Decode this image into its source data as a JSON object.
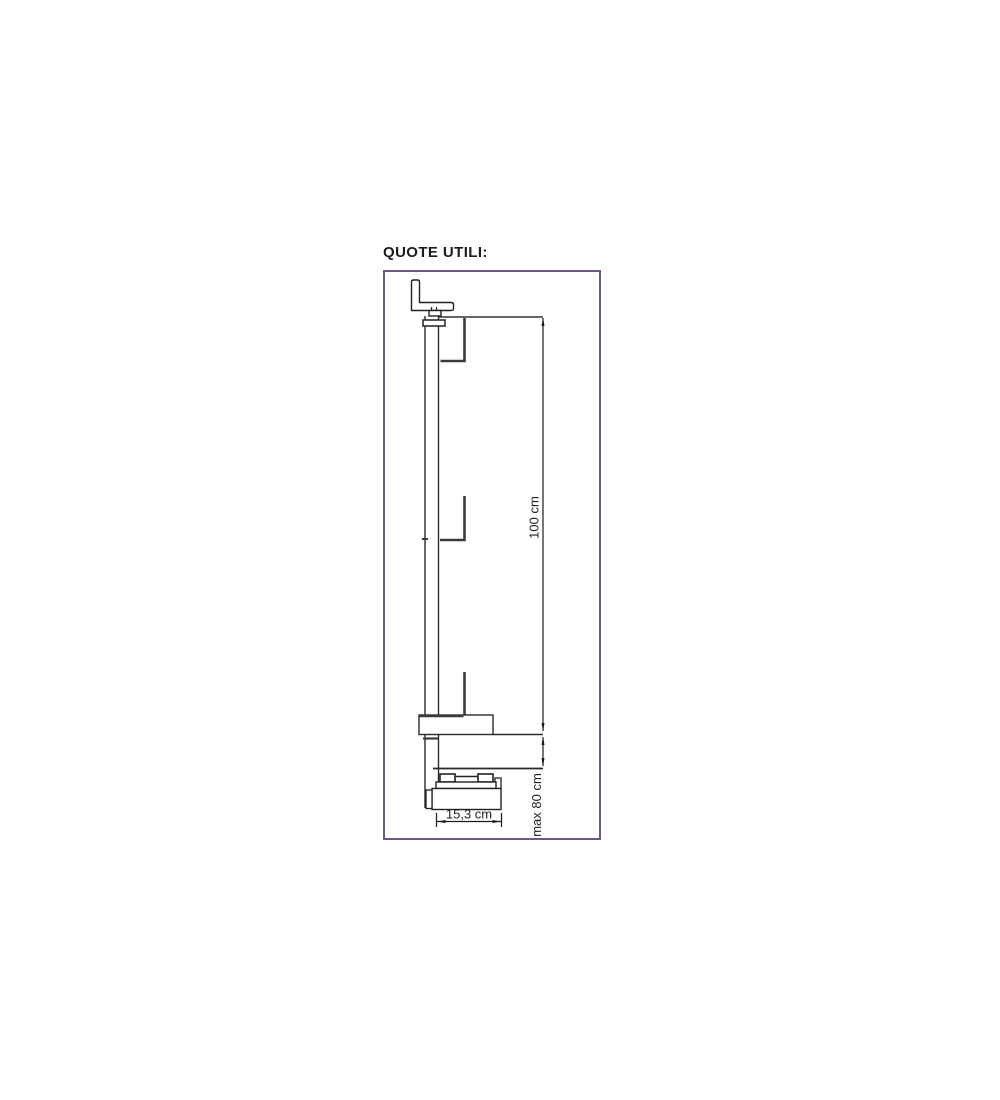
{
  "title": "QUOTE UTILI:",
  "diagram": {
    "frame_border_color": "#6f5b80",
    "ink_color": "#1f1f1f",
    "bracket_color": "#3a3a3a",
    "dim_height_total": "100 cm",
    "dim_height_max": "max 80 cm",
    "dim_depth": "15,3 cm"
  }
}
